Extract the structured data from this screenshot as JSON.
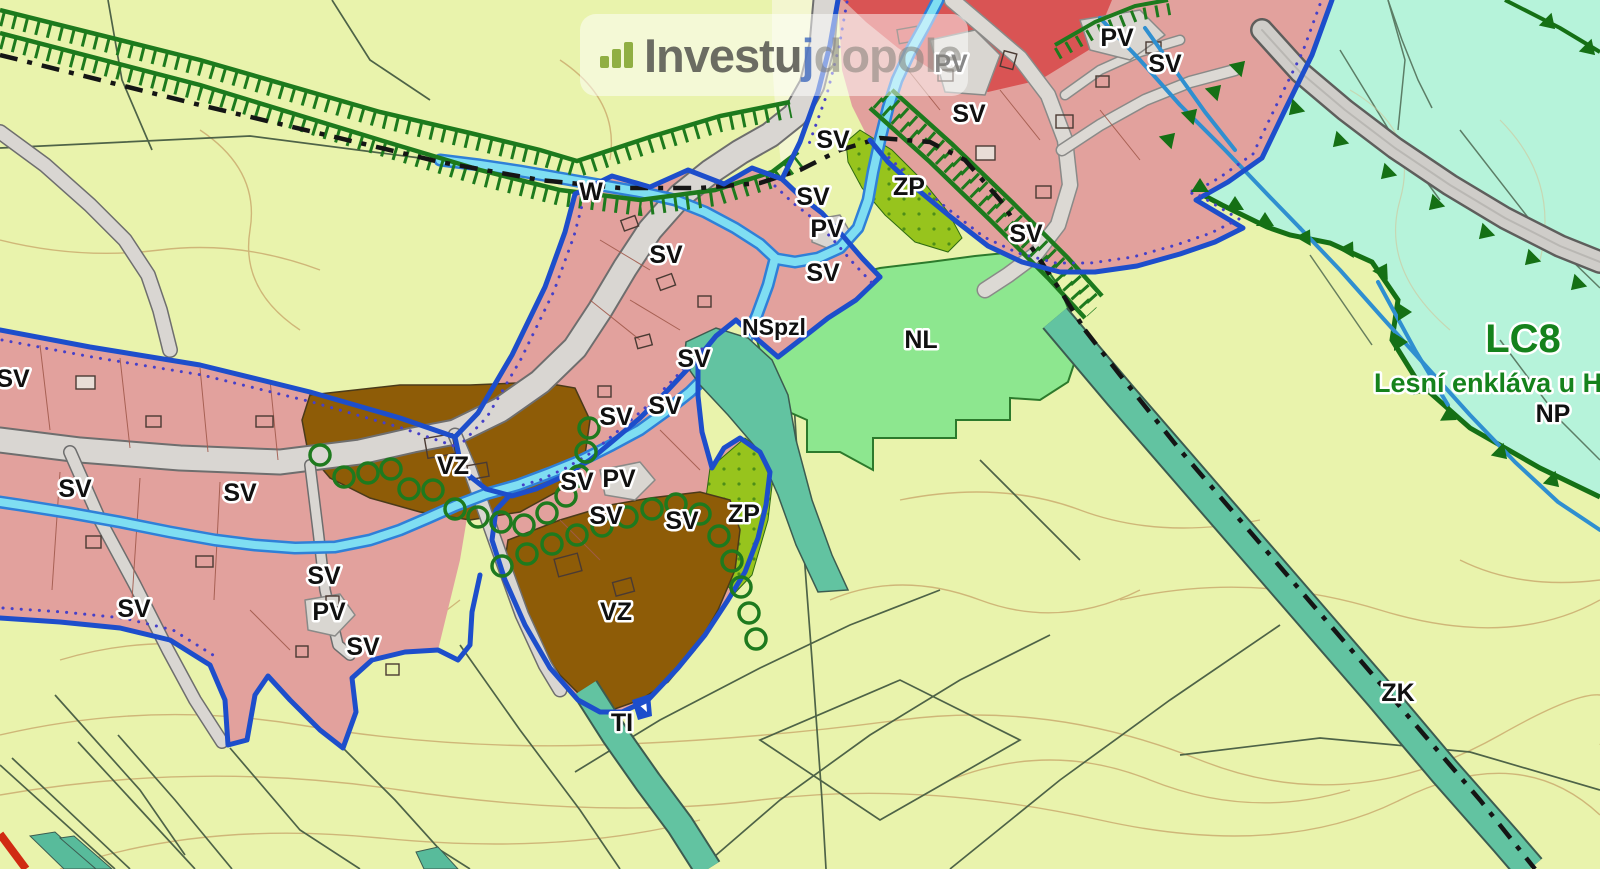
{
  "watermark": {
    "brand_prefix": "Investu",
    "brand_j": "j",
    "brand_suffix": "dopole",
    "icon": "bar-chart-icon"
  },
  "map": {
    "colors": {
      "background": "#e9f3ac",
      "residential_pink": "#e2a19d",
      "red_zone": "#d95454",
      "forest_cyan": "#b6f3da",
      "meadow_green": "#8de78f",
      "orchard_olive": "#97c41d",
      "farm_brown": "#8e5c07",
      "corridor_teal": "#62c3a1",
      "boundary_blue": "#1d4ecb",
      "stream_cyan": "#7fdef2",
      "stream_blue": "#2f80d8",
      "hatch_green": "#1d7a1d",
      "forest_edge_green": "#157015",
      "road_gray": "#d9d6d2",
      "contour_tan": "#c9a86c",
      "route_black": "#151515"
    },
    "labels": [
      {
        "text": "W",
        "x": 591,
        "y": 200,
        "cls": "lbl"
      },
      {
        "text": "SV",
        "x": 833,
        "y": 148,
        "cls": "lbl"
      },
      {
        "text": "PV",
        "x": 951,
        "y": 72,
        "cls": "lbl"
      },
      {
        "text": "SV",
        "x": 969,
        "y": 122,
        "cls": "lbl"
      },
      {
        "text": "PV",
        "x": 1117,
        "y": 46,
        "cls": "lbl"
      },
      {
        "text": "SV",
        "x": 1165,
        "y": 72,
        "cls": "lbl"
      },
      {
        "text": "ZP",
        "x": 909,
        "y": 195,
        "cls": "lbl"
      },
      {
        "text": "SV",
        "x": 1026,
        "y": 242,
        "cls": "lbl"
      },
      {
        "text": "SV",
        "x": 813,
        "y": 205,
        "cls": "lbl"
      },
      {
        "text": "PV",
        "x": 827,
        "y": 237,
        "cls": "lbl"
      },
      {
        "text": "SV",
        "x": 823,
        "y": 281,
        "cls": "lbl"
      },
      {
        "text": "SV",
        "x": 666,
        "y": 263,
        "cls": "lbl"
      },
      {
        "text": "NSpzl",
        "x": 774,
        "y": 335,
        "cls": "lbl lbl-small"
      },
      {
        "text": "NL",
        "x": 921,
        "y": 348,
        "cls": "lbl"
      },
      {
        "text": "SV",
        "x": 694,
        "y": 367,
        "cls": "lbl"
      },
      {
        "text": "SV",
        "x": 665,
        "y": 414,
        "cls": "lbl"
      },
      {
        "text": "SV",
        "x": 616,
        "y": 425,
        "cls": "lbl"
      },
      {
        "text": "SV",
        "x": 13,
        "y": 387,
        "cls": "lbl"
      },
      {
        "text": "SV",
        "x": 75,
        "y": 497,
        "cls": "lbl"
      },
      {
        "text": "SV",
        "x": 240,
        "y": 501,
        "cls": "lbl"
      },
      {
        "text": "VZ",
        "x": 453,
        "y": 474,
        "cls": "lbl"
      },
      {
        "text": "SV",
        "x": 577,
        "y": 490,
        "cls": "lbl"
      },
      {
        "text": "PV",
        "x": 619,
        "y": 487,
        "cls": "lbl"
      },
      {
        "text": "SV",
        "x": 606,
        "y": 524,
        "cls": "lbl"
      },
      {
        "text": "SV",
        "x": 682,
        "y": 529,
        "cls": "lbl"
      },
      {
        "text": "ZP",
        "x": 744,
        "y": 522,
        "cls": "lbl"
      },
      {
        "text": "VZ",
        "x": 616,
        "y": 620,
        "cls": "lbl"
      },
      {
        "text": "SV",
        "x": 324,
        "y": 584,
        "cls": "lbl"
      },
      {
        "text": "PV",
        "x": 329,
        "y": 620,
        "cls": "lbl"
      },
      {
        "text": "SV",
        "x": 134,
        "y": 617,
        "cls": "lbl"
      },
      {
        "text": "SV",
        "x": 363,
        "y": 655,
        "cls": "lbl"
      },
      {
        "text": "TI",
        "x": 622,
        "y": 731,
        "cls": "lbl"
      },
      {
        "text": "ZK",
        "x": 1398,
        "y": 701,
        "cls": "lbl"
      },
      {
        "text": "NP",
        "x": 1553,
        "y": 422,
        "cls": "lbl"
      },
      {
        "text": "LC8",
        "x": 1523,
        "y": 352,
        "cls": "lbl lbl-green lbl-big"
      },
      {
        "text": "Lesní enkláva u Heř",
        "x": 1374,
        "y": 392,
        "cls": "lbl lbl-green lbl-med lbl-start"
      }
    ]
  }
}
